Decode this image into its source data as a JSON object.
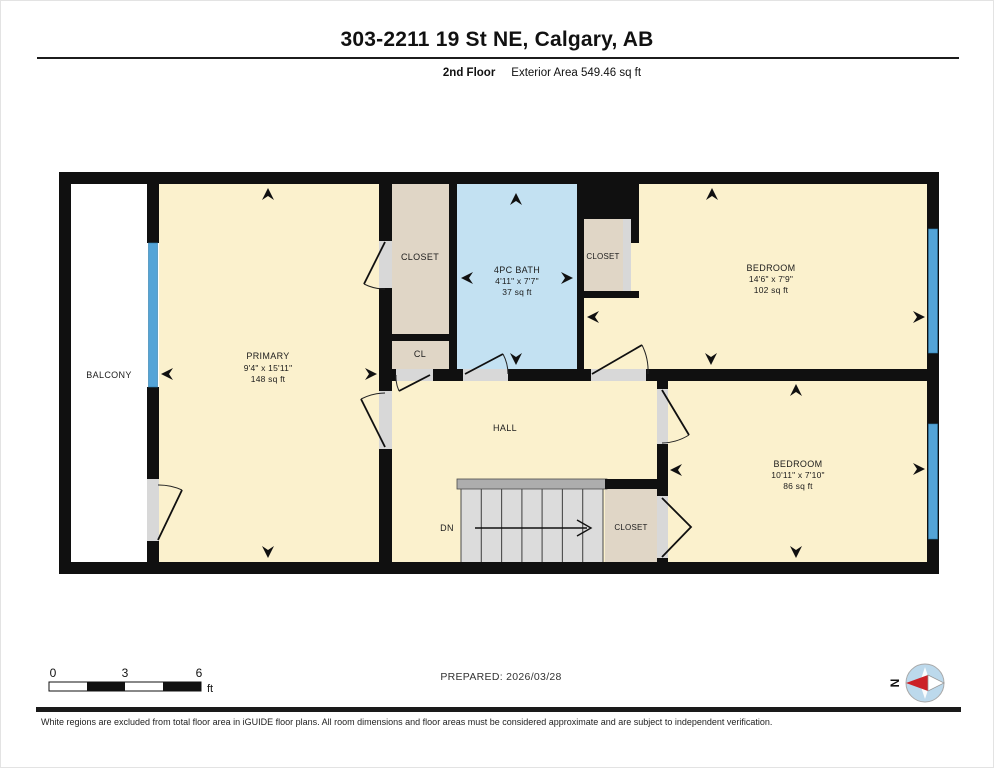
{
  "header": {
    "title": "303-2211 19 St NE, Calgary, AB",
    "floor_label": "2nd Floor",
    "area_label": "Exterior Area 549.46 sq ft"
  },
  "rooms": {
    "balcony": {
      "name": "BALCONY"
    },
    "primary": {
      "name": "PRIMARY",
      "dims": "9'4\" x 15'11\"",
      "area": "148 sq ft"
    },
    "closet_top": {
      "name": "CLOSET"
    },
    "cl": {
      "name": "CL"
    },
    "bath": {
      "name": "4PC BATH",
      "dims": "4'11\" x 7'7\"",
      "area": "37 sq ft"
    },
    "closet_bedroom": {
      "name": "CLOSET"
    },
    "bedroom_top": {
      "name": "BEDROOM",
      "dims": "14'6\" x 7'9\"",
      "area": "102 sq ft"
    },
    "hall": {
      "name": "HALL"
    },
    "stairs": {
      "label": "DN"
    },
    "closet_hall": {
      "name": "CLOSET"
    },
    "bedroom_bottom": {
      "name": "BEDROOM",
      "dims": "10'11\" x 7'10\"",
      "area": "86 sq ft"
    }
  },
  "scale_bar": {
    "ticks": [
      "0",
      "3",
      "6"
    ],
    "unit": "ft"
  },
  "prepared": {
    "label": "PREPARED: 2026/03/28"
  },
  "compass": {
    "north_label": "N"
  },
  "footer": {
    "disclaimer": "White regions are excluded from total floor area in iGUIDE floor plans. All room dimensions and floor areas must be considered approximate and are subject to independent verification."
  },
  "colors": {
    "wall": "#101010",
    "room": "#fbf1cd",
    "closet": "#e0d6c6",
    "bath": "#c3e1f2",
    "window": "#54a4d7",
    "stairs": "#dcdcdc",
    "opening": "#d8d8d8"
  }
}
